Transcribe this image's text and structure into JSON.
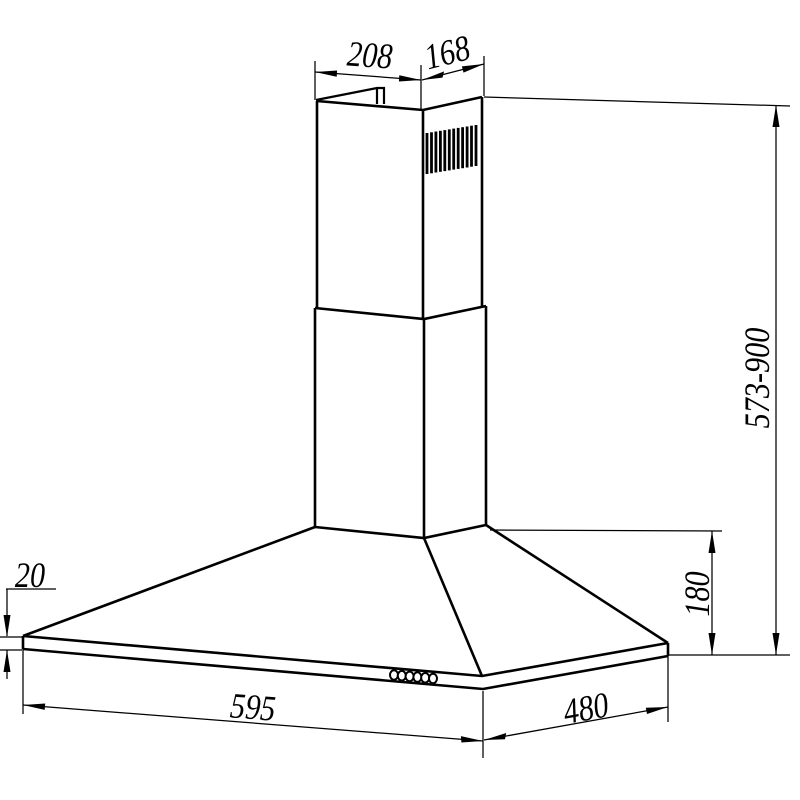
{
  "figure": {
    "title": "Chimney cooker hood dimension drawing",
    "background_color": "#ffffff",
    "line_color": "#000000"
  },
  "dimensions": {
    "chimney_top_width": "208",
    "chimney_top_depth": "168",
    "overall_height_range": "573-900",
    "hood_body_height": "180",
    "bottom_rim_thickness": "20",
    "hood_width": "595",
    "hood_depth": "480"
  },
  "features": {
    "vent_slat_count": 12,
    "control_button_count": 6,
    "chimney_sections": 2
  }
}
